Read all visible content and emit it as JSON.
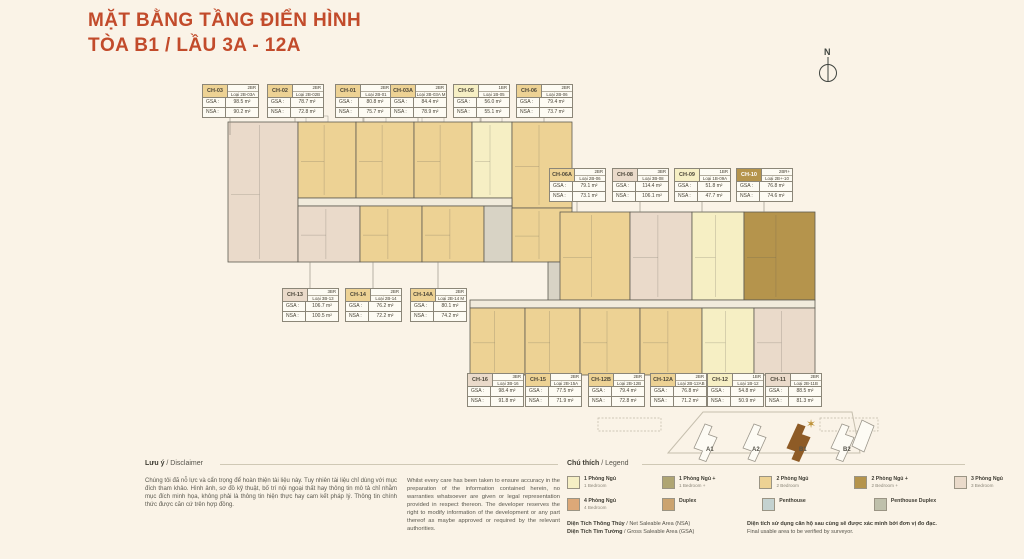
{
  "title": {
    "line1": "MẶT BẰNG TẦNG ĐIỂN HÌNH",
    "line2": "TÒA B1 / LẦU 3A - 12A"
  },
  "north_label": "N",
  "colors": {
    "accent": "#C24B2B",
    "bg": "#FAF3E7",
    "br1": "#F6EFC4",
    "br1p": "#AFA573",
    "br2": "#EDD294",
    "br2p": "#B5944C",
    "br3": "#EADACA",
    "br4": "#DCA878",
    "duplex": "#CBA36F",
    "penthouse": "#C4D2D0",
    "penthouse_duplex": "#BFC0AB",
    "wall": "#5D5A50",
    "corridor": "#F1EBDC",
    "core": "#D8D3C5",
    "b1_highlight": "#8E5B26"
  },
  "plan": {
    "gsa_label": "GSA :",
    "nsa_label": "NSA :",
    "units": [
      {
        "id": "CH-03",
        "br": "2BR",
        "loai": "Loại 2B-03A",
        "gsa": "98.5 m²",
        "nsa": "90.2 m²",
        "type": "br2"
      },
      {
        "id": "CH-02",
        "br": "2BR",
        "loai": "Loại 2B-02B",
        "gsa": "78.7 m²",
        "nsa": "72.8 m²",
        "type": "br2"
      },
      {
        "id": "CH-01",
        "br": "2BR",
        "loai": "Loại 2B-01",
        "gsa": "80.8 m²",
        "nsa": "75.7 m²",
        "type": "br2"
      },
      {
        "id": "CH-03A",
        "br": "2BR",
        "loai": "Loại 2B-03A M",
        "gsa": "84.4 m²",
        "nsa": "78.9 m²",
        "type": "br2"
      },
      {
        "id": "CH-05",
        "br": "1BR",
        "loai": "Loại 1B-05",
        "gsa": "56.0 m²",
        "nsa": "55.1 m²",
        "type": "br1"
      },
      {
        "id": "CH-06",
        "br": "2BR",
        "loai": "Loại 2B-06",
        "gsa": "79.4 m²",
        "nsa": "73.7 m²",
        "type": "br2"
      },
      {
        "id": "CH-06A",
        "br": "2BR",
        "loai": "Loại 2B-06",
        "gsa": "79.1 m²",
        "nsa": "73.1 m²",
        "type": "br2"
      },
      {
        "id": "CH-08",
        "br": "3BR",
        "loai": "Loại 3B-08",
        "gsa": "114.4 m²",
        "nsa": "106.1 m²",
        "type": "br3"
      },
      {
        "id": "CH-09",
        "br": "1BR",
        "loai": "Loại 1B-09A",
        "gsa": "51.8 m²",
        "nsa": "47.7 m²",
        "type": "br1"
      },
      {
        "id": "CH-10",
        "br": "2BR+",
        "loai": "Loại 2B+-10",
        "gsa": "76.8 m²",
        "nsa": "74.6 m²",
        "type": "br2p"
      },
      {
        "id": "CH-13",
        "br": "3BR",
        "loai": "Loại 3B-13",
        "gsa": "106.7 m²",
        "nsa": "100.5 m²",
        "type": "br3"
      },
      {
        "id": "CH-14",
        "br": "2BR",
        "loai": "Loại 2B-14",
        "gsa": "76.2 m²",
        "nsa": "72.2 m²",
        "type": "br2"
      },
      {
        "id": "CH-14A",
        "br": "2BR",
        "loai": "Loại 2B-14 M",
        "gsa": "80.1 m²",
        "nsa": "74.2 m²",
        "type": "br2"
      },
      {
        "id": "CH-16",
        "br": "3BR",
        "loai": "Loại 3B-16",
        "gsa": "98.4 m²",
        "nsa": "91.8 m²",
        "type": "br3"
      },
      {
        "id": "CH-15",
        "br": "2BR",
        "loai": "Loại 2B-15A",
        "gsa": "77.5 m²",
        "nsa": "71.9 m²",
        "type": "br2"
      },
      {
        "id": "CH-12B",
        "br": "2BR",
        "loai": "Loại 2B-12B",
        "gsa": "79.4 m²",
        "nsa": "72.8 m²",
        "type": "br2"
      },
      {
        "id": "CH-12A",
        "br": "2BR",
        "loai": "Loại 2B-12AB",
        "gsa": "76.8 m²",
        "nsa": "71.2 m²",
        "type": "br2"
      },
      {
        "id": "CH-12",
        "br": "1BR",
        "loai": "Loại 1B-12",
        "gsa": "54.8 m²",
        "nsa": "50.9 m²",
        "type": "br1"
      },
      {
        "id": "CH-11",
        "br": "2BR",
        "loai": "Loại 2B-11B",
        "gsa": "88.5 m²",
        "nsa": "81.3 m²",
        "type": "br3"
      }
    ]
  },
  "sitemap": {
    "labels": [
      "A1",
      "A2",
      "B1",
      "B2"
    ]
  },
  "disclaimer": {
    "title_bold": "Lưu ý",
    "title_rest": " / Disclaimer",
    "vi": "Chúng tôi đã nỗ lực và cẩn trọng để hoàn thiện tài liệu này. Tuy nhiên tài liệu chỉ dùng với mục đích tham khảo. Hình ảnh, sơ đồ kỹ thuật, bố trí nội ngoại thất hay thông tin mô tả chỉ nhằm mục đích minh họa, không phải là thông tin hiện thực hay cam kết pháp lý. Thông tin chính thức được căn cứ trên hợp đồng.",
    "en": "Whilst every care has been taken to ensure accuracy in the preparation of the information contained herein, no warranties whatsoever are given or legal representation provided in respect thereon. The developer reserves the right to modify information of the development or any part thereof as maybe approved or required by the relevant authorities."
  },
  "legend": {
    "title_bold": "Chú thích",
    "title_rest": " / Legend",
    "row1": [
      {
        "vn": "1 Phòng Ngủ",
        "en": "1 Bedroom",
        "type": "br1"
      },
      {
        "vn": "1 Phòng Ngủ +",
        "en": "1 Bedroom +",
        "type": "br1p"
      },
      {
        "vn": "2 Phòng Ngủ",
        "en": "2 Bedroom",
        "type": "br2"
      },
      {
        "vn": "2 Phòng Ngủ +",
        "en": "2 Bedroom +",
        "type": "br2p"
      },
      {
        "vn": "3 Phòng Ngủ",
        "en": "3 Bedroom",
        "type": "br3"
      }
    ],
    "row2": [
      {
        "vn": "4 Phòng Ngủ",
        "en": "4 Bedroom",
        "type": "br4"
      },
      {
        "vn": "Duplex",
        "en": "",
        "type": "duplex"
      },
      {
        "vn": "Penthouse",
        "en": "",
        "type": "penthouse"
      },
      {
        "vn": "Penthouse Duplex",
        "en": "",
        "type": "penthouse_duplex"
      }
    ],
    "notes_left": [
      {
        "bold": "Diện Tích Thông Thủy",
        "rest": " / Net Saleable Area (NSA)"
      },
      {
        "bold": "Diện Tích Tim Tường",
        "rest": " / Gross Saleable Area (GSA)"
      }
    ],
    "notes_right": [
      {
        "bold": "Diện tích sử dụng căn hộ sau cùng sẽ được xác minh bởi đơn vị đo đạc.",
        "rest": ""
      },
      {
        "bold": "",
        "rest": "Final usable area to be verified by surveyor."
      }
    ]
  }
}
